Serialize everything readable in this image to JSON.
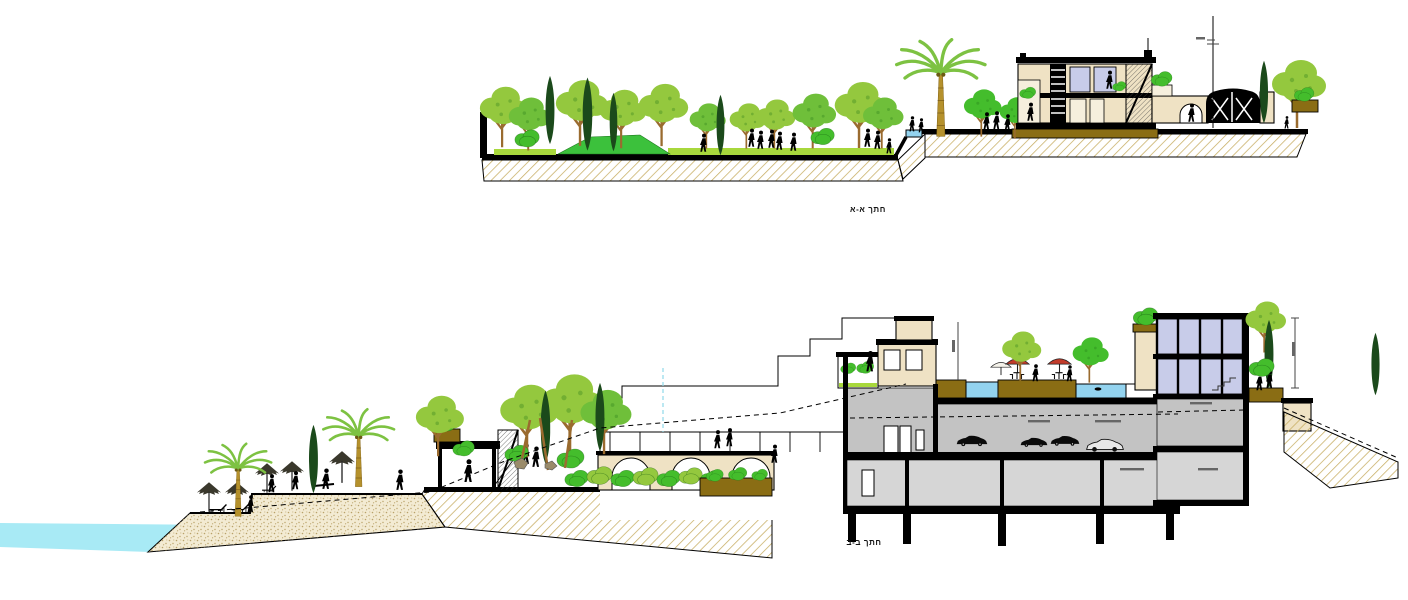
{
  "sheet": {
    "background": "#ffffff"
  },
  "sections": {
    "aa": {
      "caption": "חתך א-א"
    },
    "bb": {
      "caption": "חתך ב-ב"
    }
  },
  "palette": {
    "paper": "#ffffff",
    "canopyLight": "#94c83e",
    "canopyBright": "#44bd2c",
    "canopyMid": "#6fbf3a",
    "cypress": "#1b4a1b",
    "trunk": "#9a6b2f",
    "palmTrunk": "#b5912c",
    "palmFrond": "#7dc242",
    "grass": "#3cc13c",
    "grassStrip": "#a8d83c",
    "hatchLine": "#c7ad62",
    "sandBg": "#f3ebd3",
    "sandDot": "#b9a269",
    "soil": "#8a6d14",
    "wallCream": "#efe2c4",
    "wallCreamLight": "#f6efdd",
    "cutGray": "#c3c3c3",
    "cutGrayLight": "#d6d6d6",
    "glazing": "#c8cce9",
    "sea": "#a8eaf5",
    "pool": "#93d3ef",
    "umbrellaRed": "#c23b2a",
    "cyanDash": "#8fd8e8"
  }
}
